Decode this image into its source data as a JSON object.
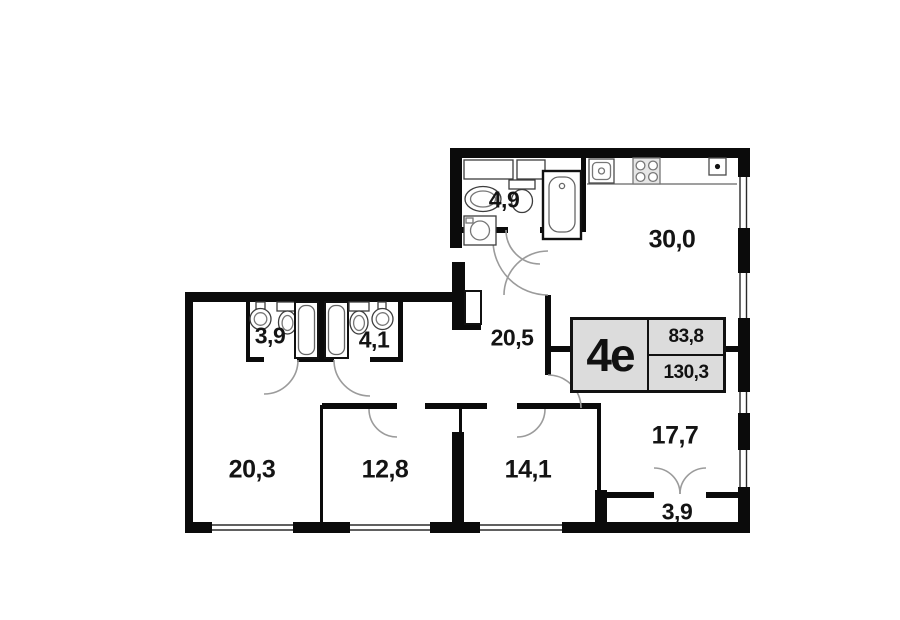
{
  "floorplan": {
    "unit": {
      "name": "4е",
      "area_living": "83,8",
      "area_total": "130,3"
    },
    "rooms": [
      {
        "id": "bathroom-top",
        "area": "4,9"
      },
      {
        "id": "kitchen-living-room",
        "area": "30,0"
      },
      {
        "id": "corridor",
        "area": "20,5"
      },
      {
        "id": "bathroom-left",
        "area": "3,9"
      },
      {
        "id": "bathroom-right",
        "area": "4,1"
      },
      {
        "id": "bedroom-1",
        "area": "20,3"
      },
      {
        "id": "bedroom-2",
        "area": "12,8"
      },
      {
        "id": "bedroom-3",
        "area": "14,1"
      },
      {
        "id": "dining-room",
        "area": "17,7"
      },
      {
        "id": "balcony",
        "area": "3,9"
      }
    ],
    "fixtures": [
      "bathtub",
      "toilet",
      "sink",
      "washing-machine",
      "stove",
      "kitchen-sink",
      "vent"
    ]
  }
}
